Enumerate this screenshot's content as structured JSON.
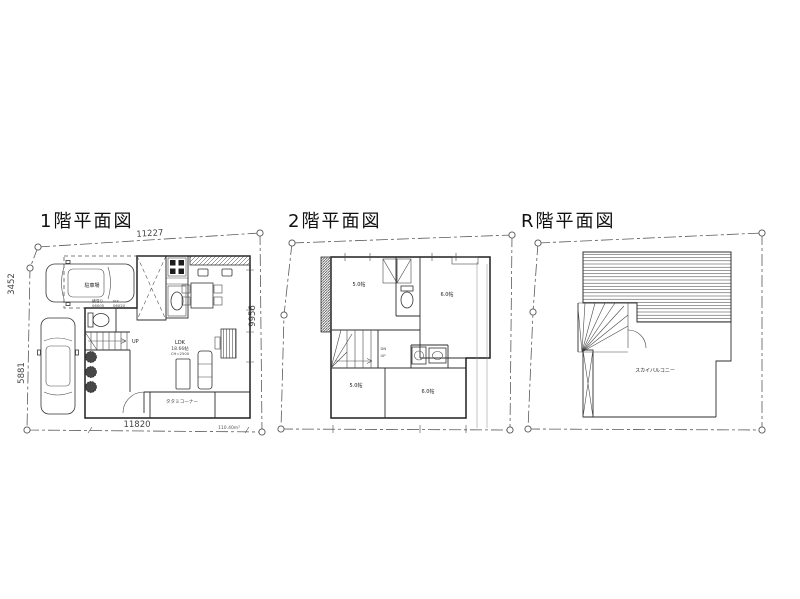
{
  "canvas": {
    "background": "#ffffff",
    "line_color": "#3a3a3a",
    "dim_color": "#555555"
  },
  "plans": {
    "f1": {
      "title": "1階平面図",
      "dim_top": "11227",
      "dim_left_upper": "3452",
      "dim_left_lower": "5881",
      "dim_bottom": "11820",
      "dim_right": "9956",
      "area": "110.40m²",
      "parking": "駐車場",
      "up": "UP",
      "win1_type": "横滑り",
      "win1_no": "06005",
      "win2_type": "FIX",
      "win2_no": "06020",
      "ldk": "LDK",
      "ldk_size": "18.66帖",
      "ldk_ch": "CH=2500",
      "tatami": "タタミコーナー"
    },
    "f2": {
      "title": "2階平面図",
      "room_nw": "5.0帖",
      "room_ne": "6.0帖",
      "room_sw": "5.0帖",
      "room_se": "6.0帖",
      "dn": "DN",
      "up": "UP"
    },
    "fr": {
      "title": "R階平面図",
      "balcony": "スカイバルコニー"
    }
  }
}
